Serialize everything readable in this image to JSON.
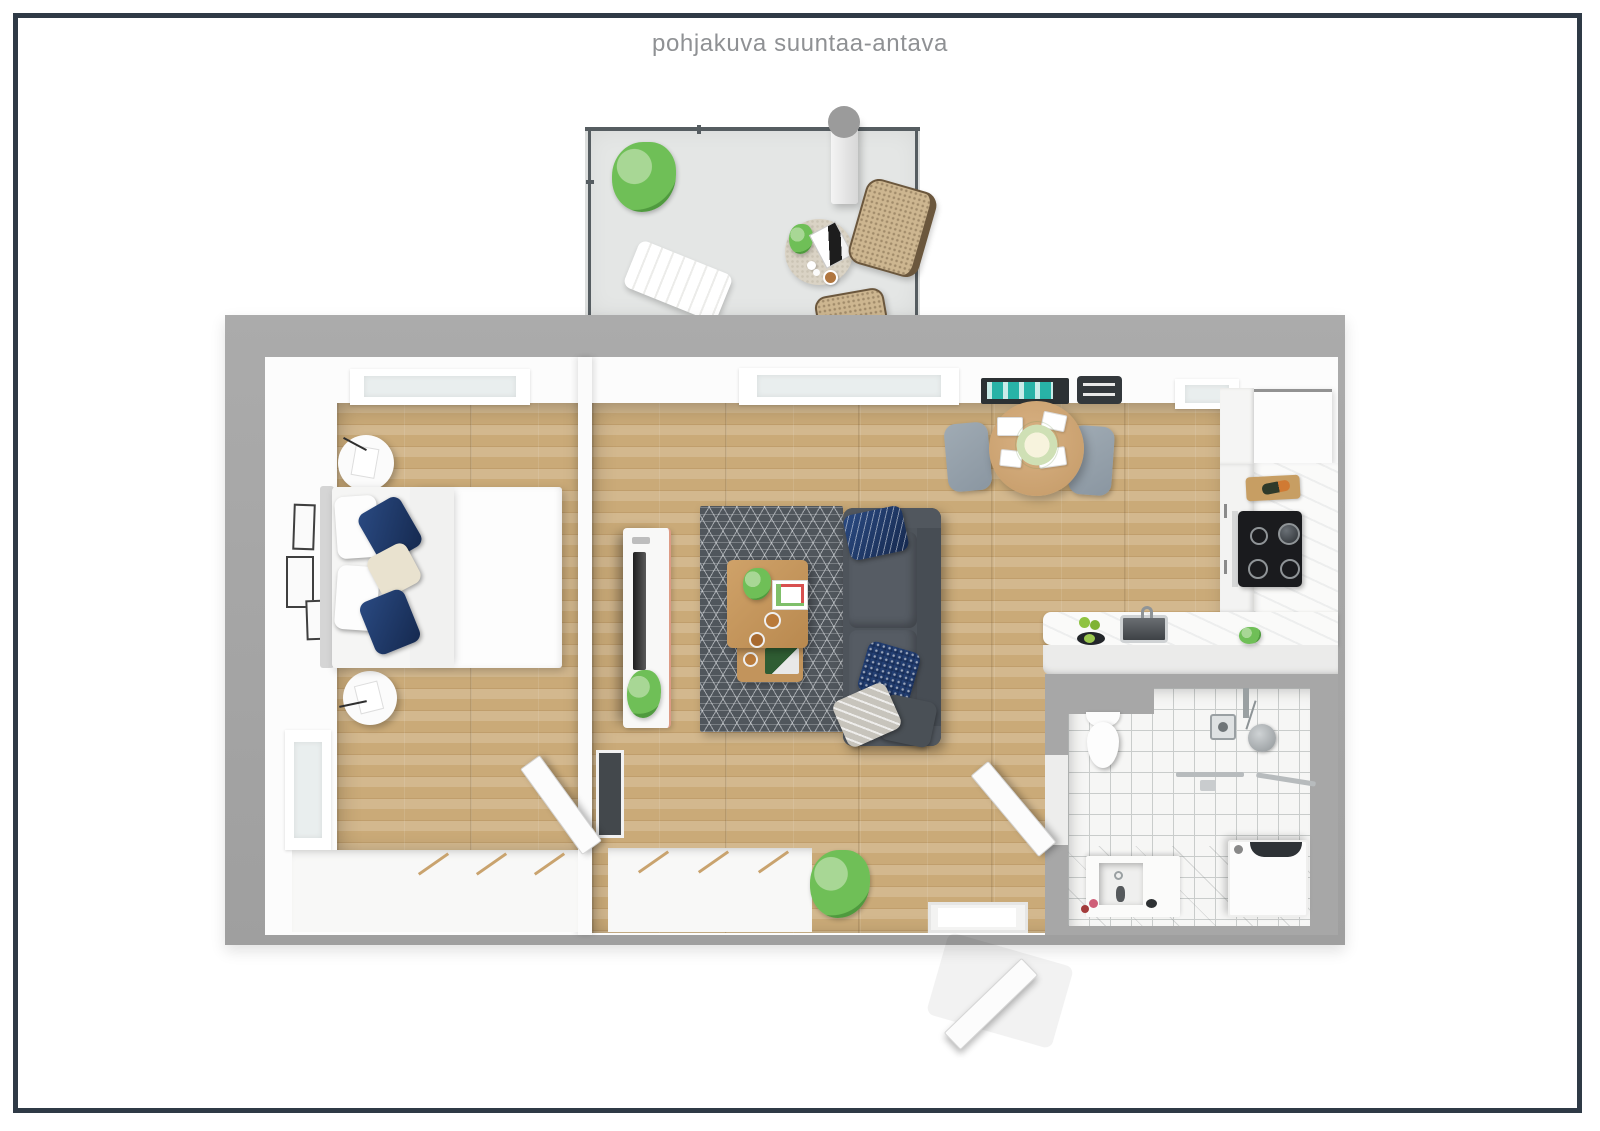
{
  "title": "pohjakuva suuntaa-antava",
  "palette": {
    "frame": "#2f3a46",
    "outer_wall": "#a8a8a8",
    "inner_wall": "#fcfcfc",
    "wood_floor": "#c9aa79",
    "balcony_floor": "#e4e6e5",
    "bathroom_tile": "#f6f6f5",
    "rug": "#50565c",
    "sofa": "#4e545b",
    "navy_accent": "#1e3a68",
    "teal_accent": "#28b3a7",
    "furniture_wood": "#c79d6b",
    "chair_gray": "#95a1ab",
    "plant_green": "#6fbf57"
  },
  "rooms": {
    "balcony": {
      "name": "balcony",
      "items": [
        "railing",
        "plant",
        "support-column",
        "side-table",
        "magazine",
        "coffee-cup",
        "wicker-chair",
        "wicker-chair",
        "lounger"
      ]
    },
    "bedroom": {
      "name": "bedroom",
      "items": [
        "top-window",
        "left-window",
        "wall-frames",
        "round-nightstand",
        "round-nightstand",
        "double-bed",
        "white-pillows",
        "navy-pillows",
        "beige-pillow",
        "duvet",
        "wardrobe",
        "door"
      ]
    },
    "living_room": {
      "name": "living-room",
      "items": [
        "window",
        "teal-wall-art",
        "wall-console",
        "dining-table",
        "flower-centerpiece",
        "place-settings",
        "dining-chair",
        "dining-chair",
        "tv-console",
        "tv",
        "plant",
        "area-rug",
        "coffee-table",
        "nesting-table",
        "sofa",
        "throw-pillows",
        "sideboard",
        "floor-plant",
        "entry-threshold",
        "entry-door"
      ]
    },
    "kitchen": {
      "name": "kitchen",
      "items": [
        "window",
        "tall-cabinet",
        "cabinet-column",
        "marble-counter",
        "cutting-board",
        "cooktop",
        "peninsula-counter",
        "sink",
        "fruit",
        "herb-plant"
      ]
    },
    "bathroom": {
      "name": "bathroom",
      "items": [
        "toilet",
        "shower-mixer",
        "shower-head",
        "towel-bar",
        "towel-bar",
        "washing-machine",
        "vanity-sink",
        "door"
      ]
    }
  }
}
